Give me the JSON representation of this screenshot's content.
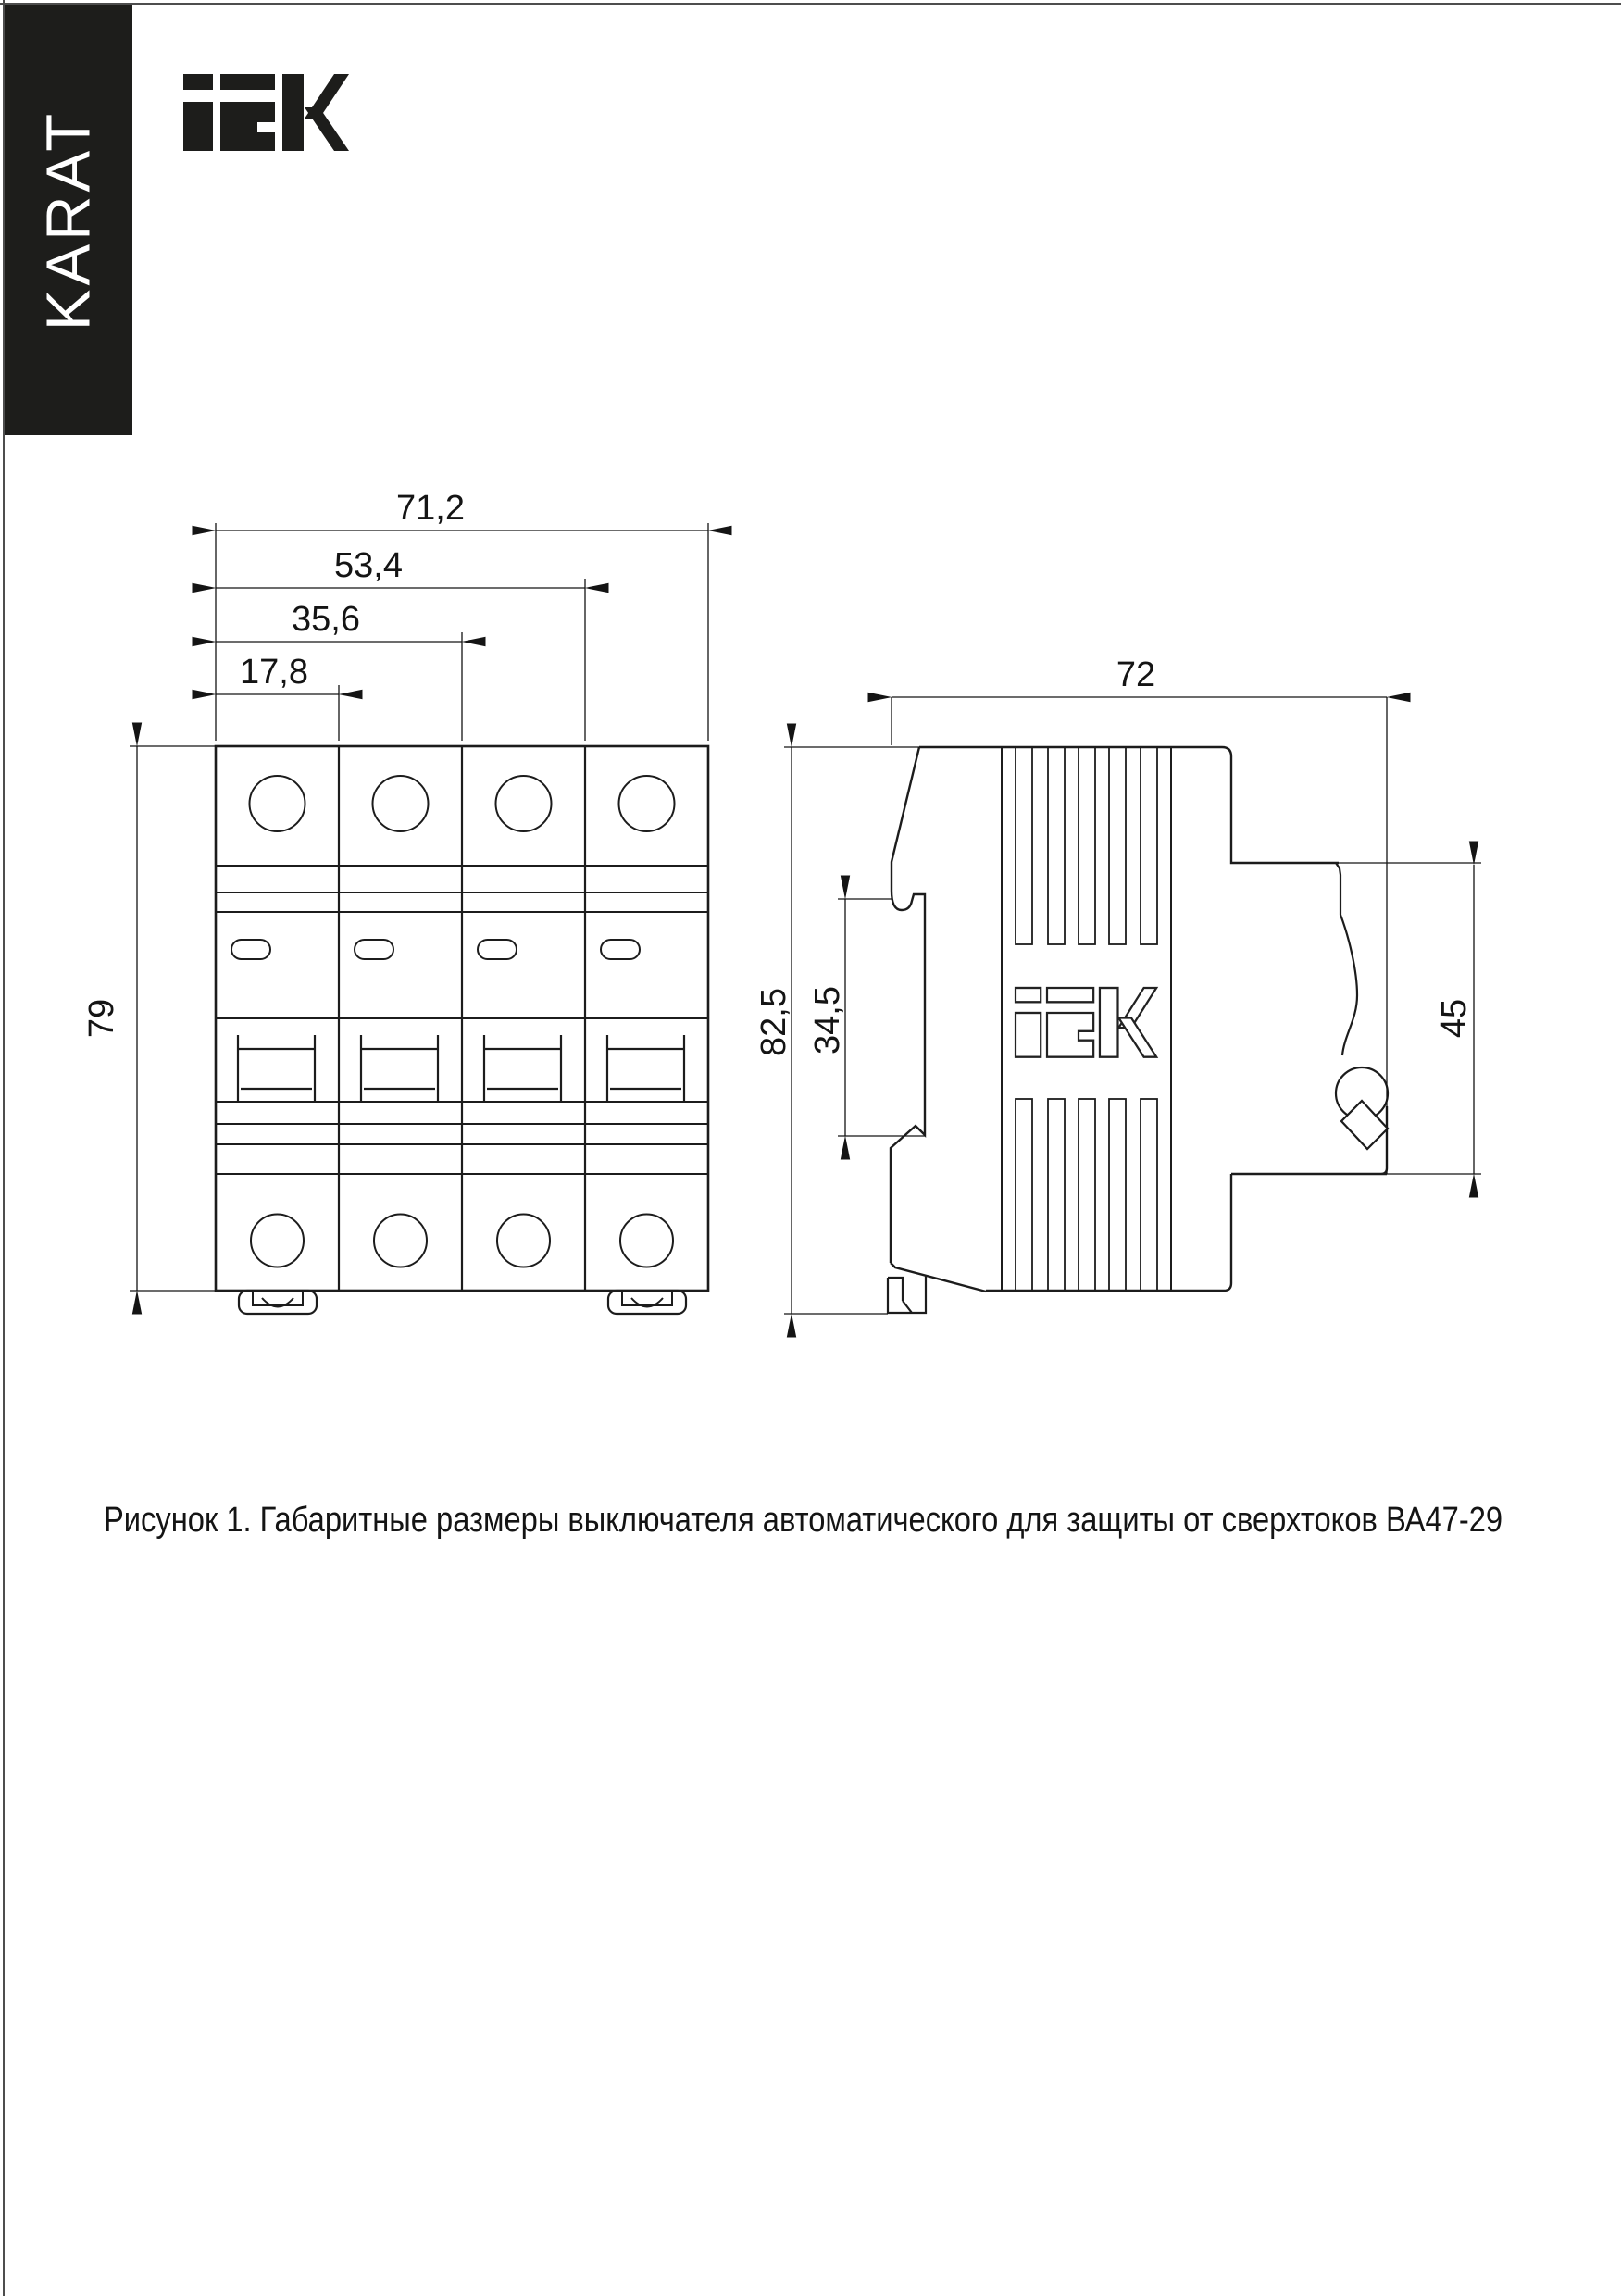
{
  "brand": {
    "karat": "KARAT",
    "iek": "IEK"
  },
  "front_view": {
    "dims": {
      "w1": "17,8",
      "w2": "35,6",
      "w3": "53,4",
      "w4": "71,2",
      "h": "79"
    }
  },
  "side_view": {
    "dims": {
      "w": "72",
      "h": "82,5",
      "rail_h": "34,5",
      "back_h": "45"
    }
  },
  "caption": {
    "text": "Рисунок 1. Габаритные размеры выключателя автоматического для защиты от сверхтоков ВА47-29"
  }
}
